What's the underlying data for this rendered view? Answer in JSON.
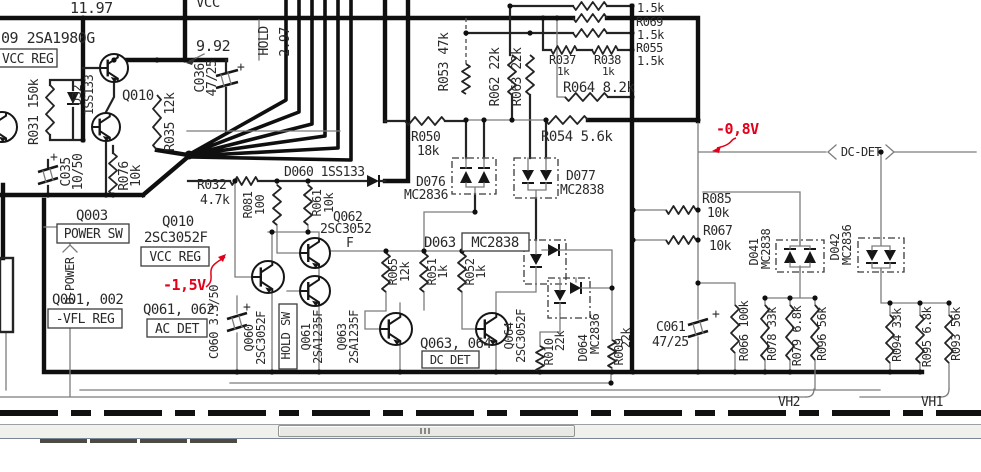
{
  "colors": {
    "wire": "#0f0f0f",
    "thin_wire": "#7c7c7c",
    "text": "#2a2a2a",
    "annotation_red": "#e3001b",
    "scrollbar_track": "#f0f0ed",
    "scrollbar_thumb": "#e8e8e4",
    "chrome_line": "#7b8794",
    "chrome_tab": "#4c4b43"
  },
  "schematic": {
    "voltages": {
      "v1197": "11.97",
      "v992": "9.92",
      "v297": "2.97"
    },
    "red_notes": {
      "neg15": "-1,5V",
      "neg08": "-0,8V"
    },
    "nets": {
      "vcc": "VCC",
      "hold": "HOLD",
      "dpower": "D-POWER",
      "dcdet": "DC-DET",
      "vh2": "VH2",
      "vh1": "VH1"
    },
    "blocks": {
      "q009": "09 2SA1980G",
      "vcc_reg_top": "VCC REG",
      "q010_top": "Q010",
      "q003": "Q003",
      "power_sw": "POWER SW",
      "q010": "Q010",
      "q010_type": "2SC3052F",
      "vcc_reg": "VCC REG",
      "q001": "Q001, 002",
      "vfl_reg": "-VFL REG",
      "q061_062": "Q061, 062",
      "ac_det": "AC DET",
      "hold_sw": "HOLD SW",
      "q063_064": "Q063, 064",
      "dc_det": "DC DET"
    },
    "parts": {
      "polarity": "+",
      "r031": "R031 150k",
      "d032": {
        "n": "D32",
        "t": "1SS133"
      },
      "r035": "R035 12k",
      "c036": {
        "n": "C036",
        "v": "47/25"
      },
      "c035": {
        "n": "C035",
        "v": "10/50"
      },
      "r076": {
        "n": "R076",
        "v": "10k"
      },
      "r032": {
        "n": "R032",
        "v": "4.7k"
      },
      "c060": "C060 3.3/50",
      "q060": {
        "n": "Q060",
        "t": "2SC3052F"
      },
      "q061": {
        "n": "Q061",
        "t": "2SA1235F"
      },
      "q063": {
        "n": "Q063",
        "t": "2SA1235F"
      },
      "r081": {
        "n": "R081",
        "v": "100"
      },
      "r061": {
        "n": "R061",
        "v": "10k"
      },
      "d060": "D060 1SS133",
      "q062": {
        "n": "Q062",
        "t": "2SC3052",
        "s": "F"
      },
      "r065": {
        "n": "R065",
        "v": "12k"
      },
      "r051": {
        "n": "R051",
        "v": "1k"
      },
      "r052": {
        "n": "R052",
        "v": "1k"
      },
      "d063": {
        "n": "D063",
        "t": "MC2838"
      },
      "q064": {
        "n": "Q064",
        "t": "2SC3052F"
      },
      "r010": {
        "n": "R010",
        "v": "22k"
      },
      "d064": {
        "n": "D064",
        "t": "MC2836"
      },
      "r009": {
        "n": "R009",
        "v": "22k"
      },
      "c061": {
        "n": "C061",
        "v": "47/25"
      },
      "r053": "R053 47k",
      "r050": {
        "n": "R050",
        "v": "18k"
      },
      "r062": "R062 22k",
      "r063": "R063 22k",
      "r037": {
        "n": "R037",
        "v": "1k"
      },
      "r038": {
        "n": "R038",
        "v": "1k"
      },
      "r064": "R064 8.2k",
      "r_unnamed": "1.5k",
      "r069": {
        "n": "R069",
        "v": "1.5k"
      },
      "r055": {
        "n": "R055",
        "v": "1.5k"
      },
      "r054": "R054 5.6k",
      "d076": {
        "n": "D076",
        "t": "MC2836"
      },
      "d077": {
        "n": "D077",
        "t": "MC2838"
      },
      "r085": {
        "n": "R085",
        "v": "10k"
      },
      "r067": {
        "n": "R067",
        "v": "10k"
      },
      "d041": {
        "n": "D041",
        "t": "MC2838"
      },
      "d042": {
        "n": "D042",
        "t": "MC2836"
      },
      "r066": "R066 100k",
      "r078": "R078 33k",
      "r079": "R079 6.8k",
      "r096": "R096 56k",
      "r094": "R094 33k",
      "r095": "R095 6.8k",
      "r093": "R093 56k"
    }
  }
}
